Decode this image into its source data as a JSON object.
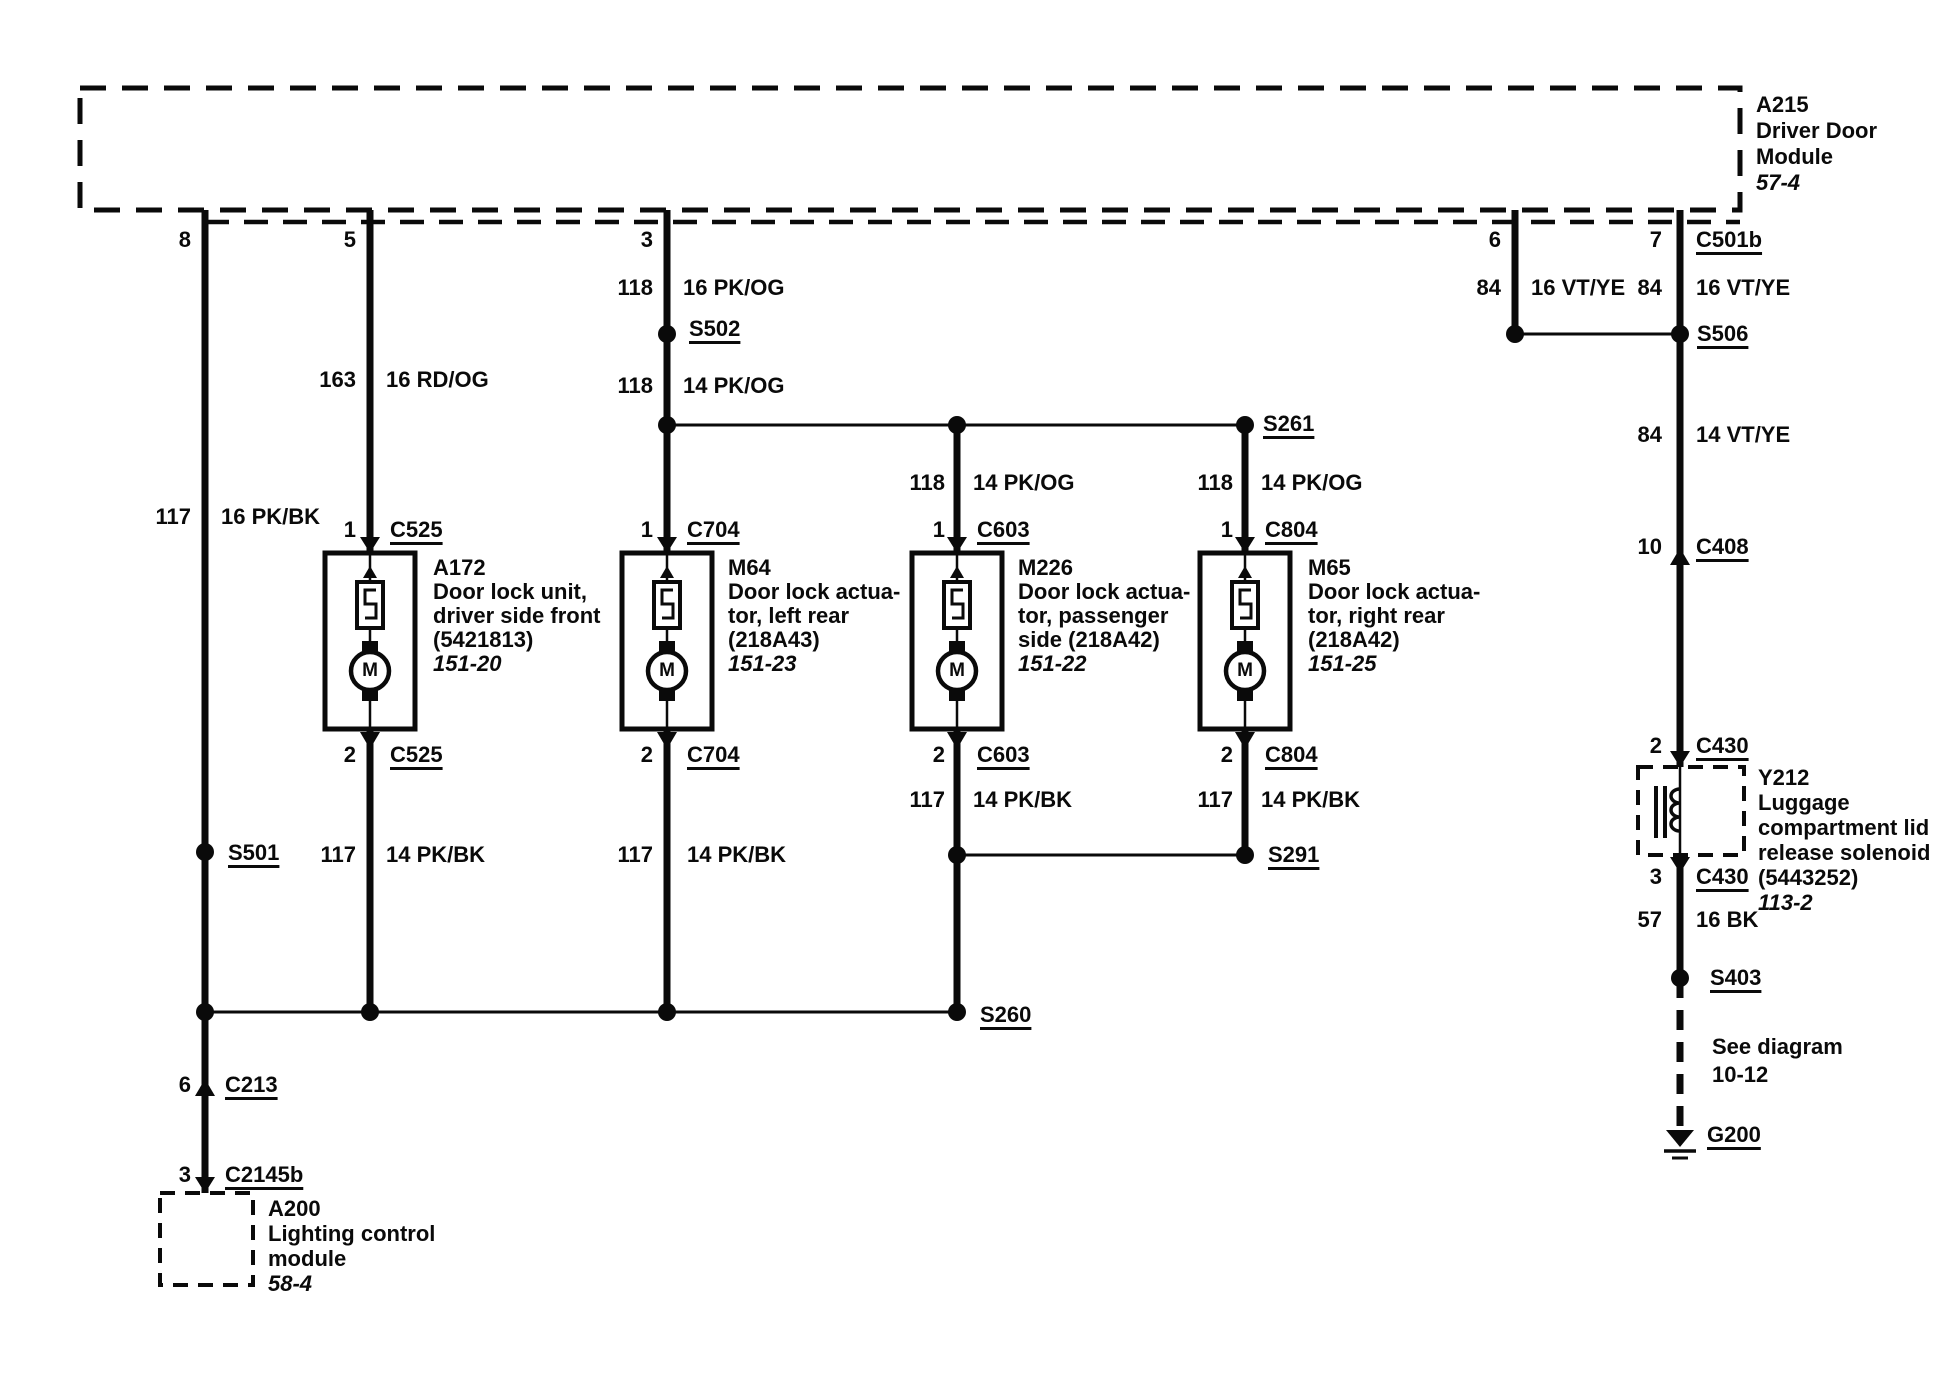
{
  "page": {
    "paper_color": "#ffffff",
    "ink_color": "#0a0a0a"
  },
  "module": {
    "id": "A215",
    "lines": [
      "Driver Door",
      "Module"
    ],
    "page_ref": "57-4",
    "connector": "C501b"
  },
  "pins": {
    "p8": "8",
    "p5": "5",
    "p3": "3",
    "p6": "6",
    "p7": "7",
    "lock_in": "1",
    "lock_out": "2",
    "c408": "10",
    "c430_in": "2",
    "c430_out": "3",
    "c213": "6",
    "c2145b": "3"
  },
  "connectors": {
    "c501b": "C501b",
    "c525": "C525",
    "c704": "C704",
    "c603": "C603",
    "c804": "C804",
    "c408": "C408",
    "c430": "C430",
    "c213": "C213",
    "c2145b": "C2145b"
  },
  "splices": {
    "s501": "S501",
    "s502": "S502",
    "s506": "S506",
    "s261": "S261",
    "s291": "S291",
    "s260": "S260",
    "s403": "S403"
  },
  "ground": {
    "id": "G200"
  },
  "segments": {
    "w1_pkbk16": {
      "cct": "117",
      "col": "16 PK/BK"
    },
    "w2_rdog16": {
      "cct": "163",
      "col": "16 RD/OG"
    },
    "w2_pkbk14": {
      "cct": "117",
      "col": "14 PK/BK"
    },
    "w3_pkog16": {
      "cct": "118",
      "col": "16 PK/OG"
    },
    "w3_pkog14": {
      "cct": "118",
      "col": "14 PK/OG"
    },
    "w3_pkbk14": {
      "cct": "117",
      "col": "14 PK/BK"
    },
    "w4_pkog14": {
      "cct": "118",
      "col": "14 PK/OG"
    },
    "w4_pkbk14": {
      "cct": "117",
      "col": "14 PK/BK"
    },
    "w5_pkog14": {
      "cct": "118",
      "col": "14 PK/OG"
    },
    "w5_pkbk14": {
      "cct": "117",
      "col": "14 PK/BK"
    },
    "w6_vtye16": {
      "cct": "84",
      "col": "16 VT/YE"
    },
    "w7_vtye16": {
      "cct": "84",
      "col": "16 VT/YE"
    },
    "w7_vtye14": {
      "cct": "84",
      "col": "14 VT/YE"
    },
    "w7_bk16": {
      "cct": "57",
      "col": "16 BK"
    }
  },
  "components": {
    "a172": {
      "id": "A172",
      "lines": [
        "Door lock unit,",
        "driver side front",
        "(5421813)"
      ],
      "page_ref": "151-20"
    },
    "m64": {
      "id": "M64",
      "lines": [
        "Door lock actua-",
        "tor, left rear",
        "(218A43)"
      ],
      "page_ref": "151-23"
    },
    "m226": {
      "id": "M226",
      "lines": [
        "Door lock actua-",
        "tor, passenger",
        "side (218A42)"
      ],
      "page_ref": "151-22"
    },
    "m65": {
      "id": "M65",
      "lines": [
        "Door lock actua-",
        "tor, right rear",
        "(218A42)"
      ],
      "page_ref": "151-25"
    },
    "y212": {
      "id": "Y212",
      "lines": [
        "Luggage",
        "compartment lid",
        "release solenoid",
        "(5443252)"
      ],
      "page_ref": "113-2"
    },
    "a200": {
      "id": "A200",
      "lines": [
        "Lighting control",
        "module"
      ],
      "page_ref": "58-4"
    }
  },
  "symbols": {
    "motor": "M"
  },
  "note": {
    "line1": "See diagram",
    "line2": "10-12"
  }
}
